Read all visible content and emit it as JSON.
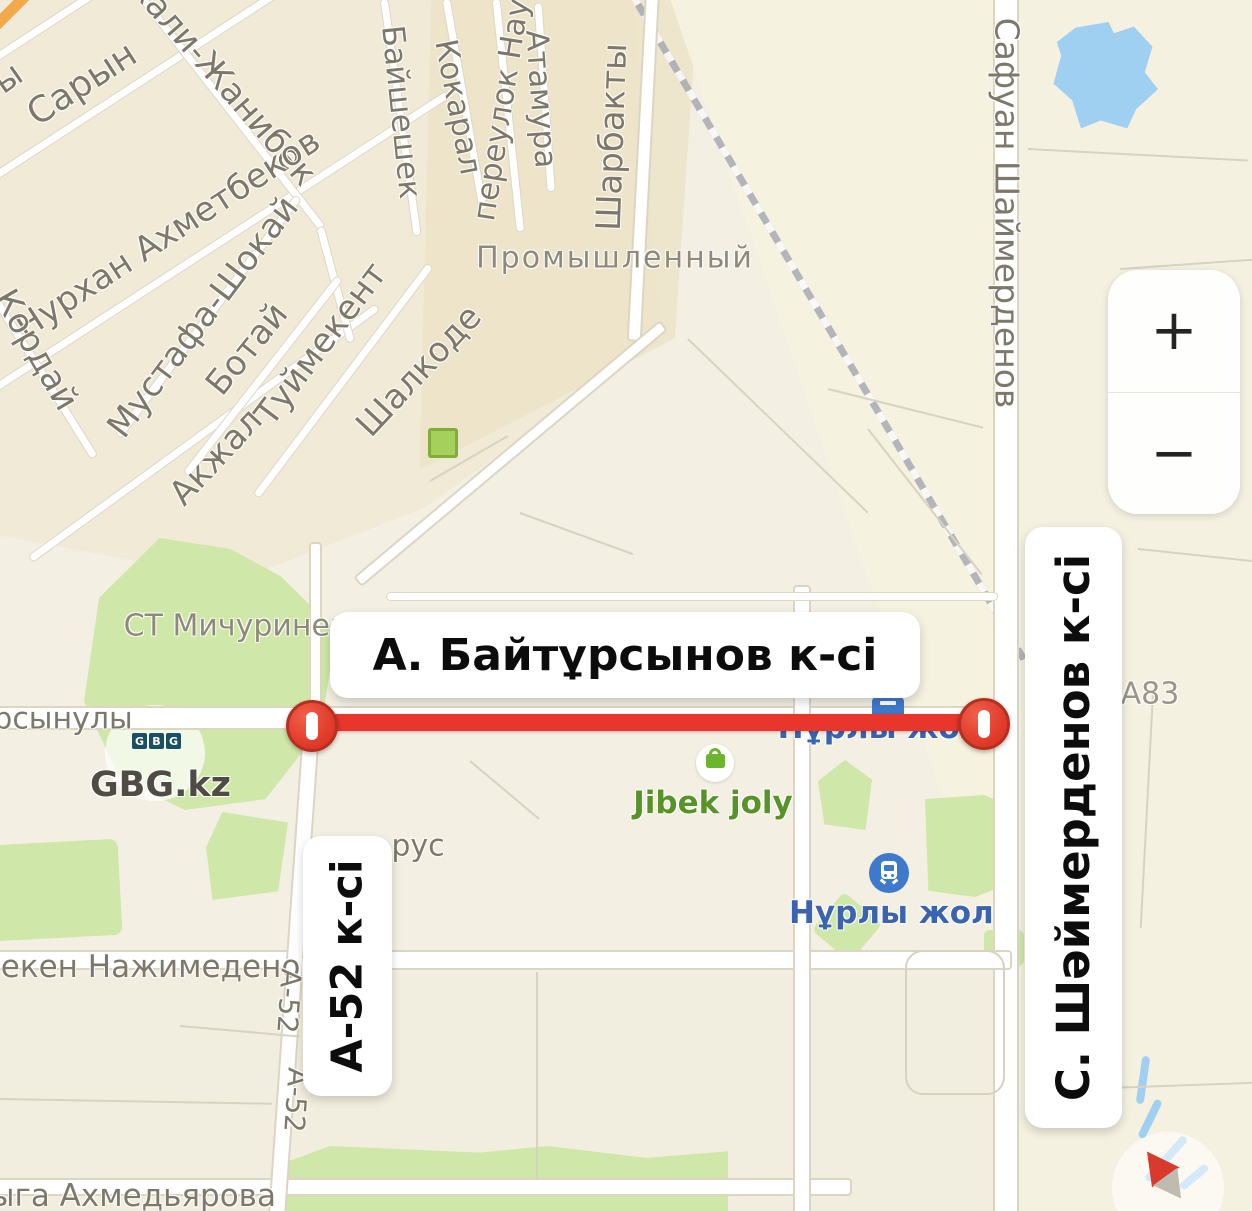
{
  "map": {
    "closure": {
      "street_label": "А. Байтұрсынов к-сі",
      "cross_street_left": "А-52 к-сі",
      "cross_street_right": "С. Шәймерденов к-сі"
    },
    "streets": {
      "partial_y": "ы",
      "saryn": "Сарын",
      "zhanibek": "кали-Жанибек",
      "akhmetbekov": "Нурхан Ахметбеков",
      "kordai": "Кордай",
      "mustafa_shokai": "Мустафа-Шокай",
      "botai": "Ботай",
      "tuimekent": "Туймекент",
      "akzhal": "Акжал",
      "baisheshek": "Байшешек",
      "kokaral": "Кокарал",
      "pereulok_naur": "переулок Наур",
      "atamura": "Атамура",
      "sharbakty": "Шарбакты",
      "shalkode": "Шалкоде",
      "safuan_shaimerdenov": "Сафуан Шаймерденов",
      "ursynuly": "рсынулы",
      "nazhimedenov": "мекен Нажимеденов",
      "akhmedyarova": "ыга Ахмедьярова",
      "rus": "рус",
      "a52_upper": "А-52",
      "a52_lower": "А-52",
      "a83": "А83"
    },
    "districts": {
      "michurinets": "СТ Мичуринец",
      "promyshlenny": "Промышленный"
    },
    "pois": {
      "gbg_letters": [
        "G",
        "B",
        "G"
      ],
      "gbg_site": "GBG.kz",
      "jibek_joly": "Jibek joly",
      "nurly_zhol_street": "Нұрлы жол",
      "nurly_zhol_station": "Нұрлы жол"
    },
    "controls": {
      "zoom_in": "+",
      "zoom_out": "−"
    },
    "colors": {
      "closure_red": "#e8362d",
      "marker_border": "#b5301f",
      "water": "#9fd0f2",
      "park": "#cfe7a8",
      "road_casing": "#dbd5c2",
      "poi_blue": "#3a63b0",
      "poi_green": "#579326",
      "street_gray": "#7e786b",
      "background": "#f3efe3"
    }
  }
}
